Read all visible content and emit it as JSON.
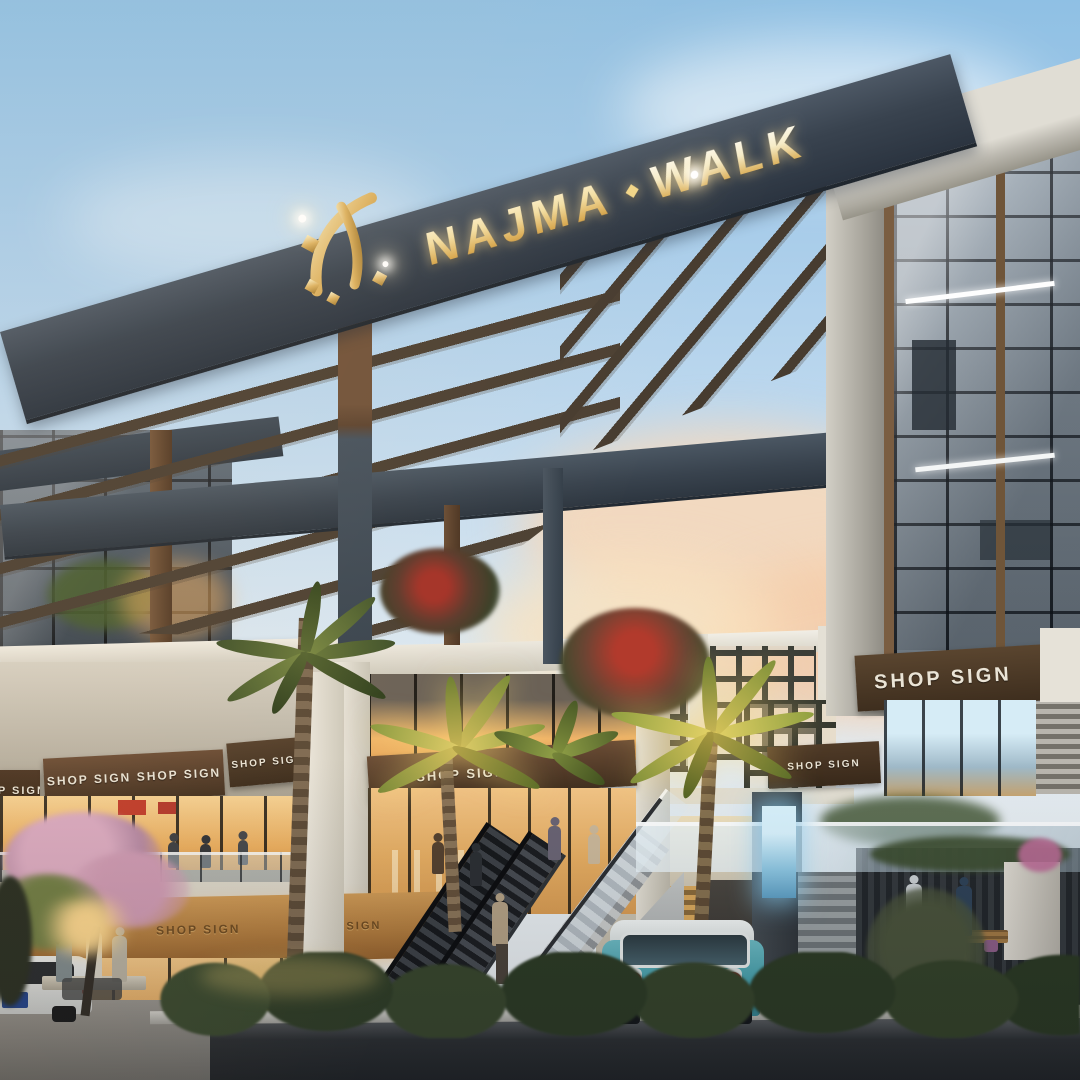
{
  "brand": {
    "word1": "NAJMA",
    "word2": "WALK",
    "separator": "◆"
  },
  "signs": {
    "shop": "SHOP SIGN"
  },
  "car": {
    "plate": "EVERMOTION"
  },
  "palette": {
    "sky_top": "#8fc0e4",
    "sunset_cloud": "#f4d5b8",
    "beam_slate": "#39434f",
    "wood_column": "#6b4e37",
    "gold_logo": "#e3b964",
    "stone_white": "#e9e5db",
    "fascia_wood": "#543c29",
    "fascia_lit": "#c08a4a",
    "glass_warm": "#f5c178",
    "glass_cool": "#95a2ae",
    "screen_blue": "#9fd8f0",
    "car_teal": "#55abb5",
    "road_asphalt": "#26292b",
    "hedge_green": "#2f3d28"
  }
}
